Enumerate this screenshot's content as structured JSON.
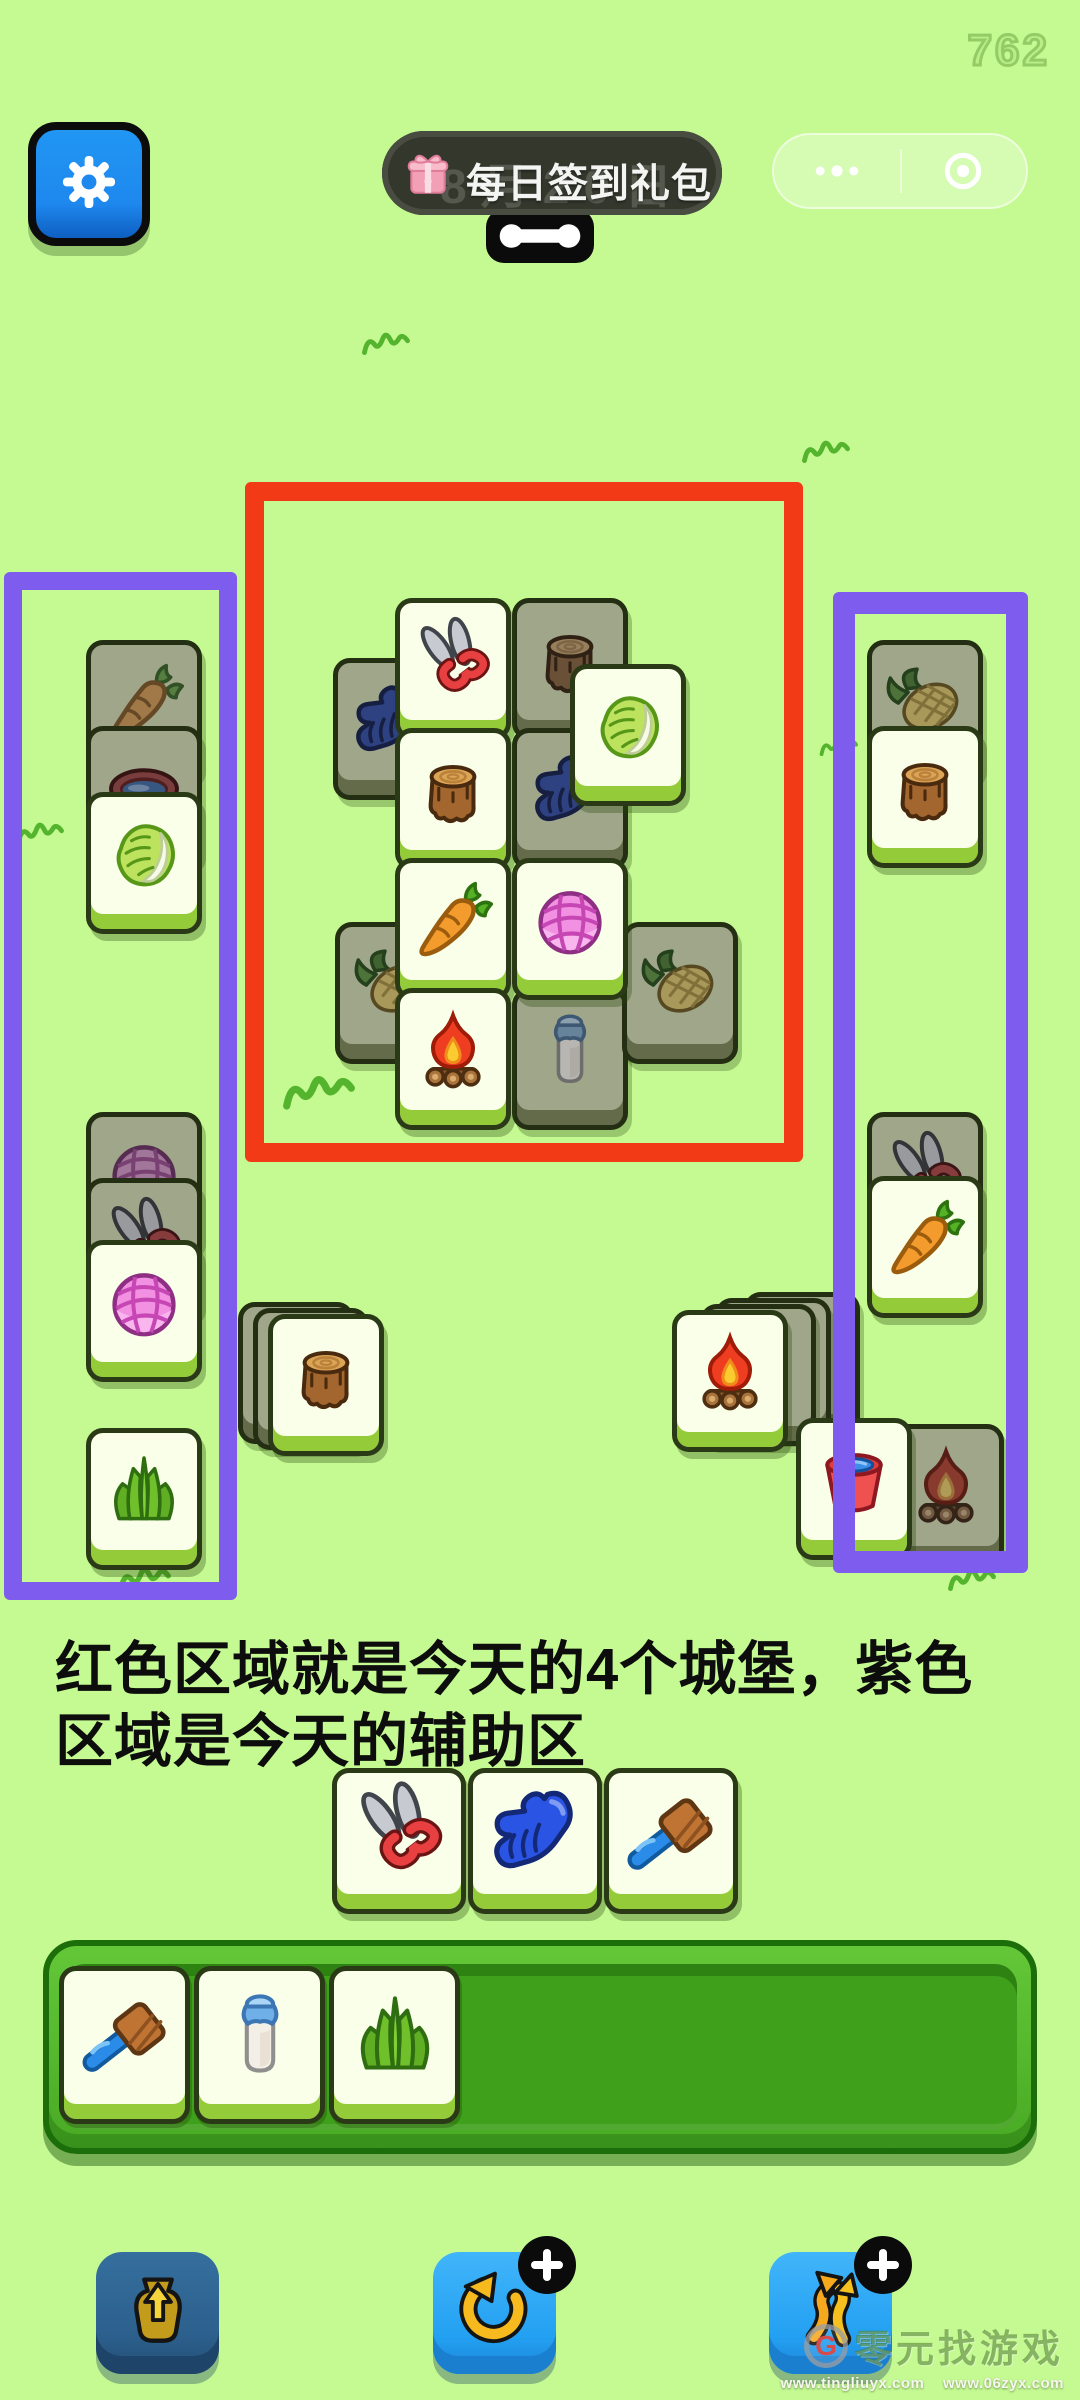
{
  "hud": {
    "counter": "762"
  },
  "topbar": {
    "signin": {
      "label": "每日签到礼包",
      "ghost_date": "8月20日"
    }
  },
  "caption": {
    "line1": "红色区域就是今天的4个城堡，紫色",
    "line2": "区域是今天的辅助区"
  },
  "watermark": {
    "logo_letter": "G",
    "brand": "零元找游戏",
    "url1": "www.tingliuyx.com",
    "url2": "www.06zyx.com"
  },
  "colors": {
    "background": "#c5fa93",
    "red_region": "#f23a17",
    "purple_region": "#7e5cee",
    "tile_face": "#f9ffe8",
    "tile_face_covered": "#a0a68a",
    "button_blue": "#29a4f5",
    "settings_blue": "#1e88ee",
    "signin_pill": "#33372c"
  },
  "board": {
    "tile_w": 116,
    "tile_h": 142,
    "tiles": [
      {
        "icon": "stump",
        "state": "covered",
        "x": 512,
        "y": 598
      },
      {
        "icon": "glove",
        "state": "covered",
        "x": 333,
        "y": 658
      },
      {
        "icon": "shears",
        "state": "open",
        "x": 395,
        "y": 598
      },
      {
        "icon": "glove",
        "state": "covered",
        "x": 512,
        "y": 728
      },
      {
        "icon": "cabbage",
        "state": "open",
        "x": 570,
        "y": 664
      },
      {
        "icon": "stump",
        "state": "open",
        "x": 395,
        "y": 728
      },
      {
        "icon": "corn",
        "state": "covered",
        "x": 335,
        "y": 922
      },
      {
        "icon": "milk",
        "state": "covered",
        "x": 512,
        "y": 988
      },
      {
        "icon": "corn",
        "state": "covered",
        "x": 622,
        "y": 922
      },
      {
        "icon": "carrot",
        "state": "open",
        "x": 395,
        "y": 858
      },
      {
        "icon": "yarn",
        "state": "open",
        "x": 512,
        "y": 858
      },
      {
        "icon": "fire",
        "state": "open",
        "x": 395,
        "y": 988
      },
      {
        "icon": "carrot",
        "state": "covered",
        "x": 86,
        "y": 640
      },
      {
        "icon": "basin",
        "state": "covered",
        "x": 86,
        "y": 726
      },
      {
        "icon": "cabbage",
        "state": "open",
        "x": 86,
        "y": 792
      },
      {
        "icon": "yarn",
        "state": "covered",
        "x": 86,
        "y": 1112
      },
      {
        "icon": "shears",
        "state": "covered",
        "x": 86,
        "y": 1178
      },
      {
        "icon": "yarn",
        "state": "open",
        "x": 86,
        "y": 1240
      },
      {
        "icon": "grass",
        "state": "open",
        "x": 86,
        "y": 1428
      },
      {
        "icon": "stump",
        "state": "covered",
        "x": 238,
        "y": 1302
      },
      {
        "icon": "stump",
        "state": "covered",
        "x": 253,
        "y": 1308
      },
      {
        "icon": "stump",
        "state": "open",
        "x": 268,
        "y": 1314
      },
      {
        "icon": "fire",
        "state": "covered",
        "x": 744,
        "y": 1292
      },
      {
        "icon": "fire",
        "state": "covered",
        "x": 715,
        "y": 1298
      },
      {
        "icon": "fire",
        "state": "covered",
        "x": 700,
        "y": 1304
      },
      {
        "icon": "fire",
        "state": "open",
        "x": 672,
        "y": 1310
      },
      {
        "icon": "corn",
        "state": "covered",
        "x": 867,
        "y": 640
      },
      {
        "icon": "stump",
        "state": "open",
        "x": 867,
        "y": 726
      },
      {
        "icon": "shears",
        "state": "covered",
        "x": 867,
        "y": 1112
      },
      {
        "icon": "carrot",
        "state": "open",
        "x": 867,
        "y": 1176
      },
      {
        "icon": "fire",
        "state": "covered",
        "x": 888,
        "y": 1424
      },
      {
        "icon": "bucket",
        "state": "open",
        "x": 796,
        "y": 1418
      }
    ],
    "regions": [
      {
        "name": "red-castle-region",
        "x": 245,
        "y": 482,
        "w": 558,
        "h": 680,
        "border": 19,
        "color": "#f23a17"
      },
      {
        "name": "purple-helper-left",
        "x": 4,
        "y": 572,
        "w": 233,
        "h": 1028,
        "border": 18,
        "color": "#7e5cee"
      },
      {
        "name": "purple-helper-right",
        "x": 833,
        "y": 592,
        "w": 195,
        "h": 981,
        "border": 22,
        "color": "#7e5cee"
      }
    ],
    "doodles": [
      {
        "x": 360,
        "y": 330,
        "s": 1
      },
      {
        "x": 800,
        "y": 438,
        "s": 1
      },
      {
        "x": 14,
        "y": 820,
        "s": 1
      },
      {
        "x": 818,
        "y": 736,
        "s": 0.8
      },
      {
        "x": 280,
        "y": 1072,
        "s": 1.5
      },
      {
        "x": 116,
        "y": 1564,
        "s": 1.1
      },
      {
        "x": 946,
        "y": 1566,
        "s": 1
      }
    ]
  },
  "tray": {
    "w": 134,
    "h": 146,
    "y": 1768,
    "tiles": [
      {
        "icon": "shears",
        "x": 332
      },
      {
        "icon": "glove",
        "x": 468
      },
      {
        "icon": "brush",
        "x": 604
      }
    ]
  },
  "slotbar": {
    "w": 131,
    "h": 158,
    "y": 1966,
    "tiles": [
      {
        "icon": "brush",
        "x": 59
      },
      {
        "icon": "milk",
        "x": 194
      },
      {
        "icon": "grass",
        "x": 329
      }
    ]
  },
  "buttons": [
    {
      "name": "bag-button",
      "icon": "bag",
      "variant": "dark",
      "x": 96,
      "y": 2252,
      "w": 123,
      "h": 122,
      "badge": false
    },
    {
      "name": "undo-button",
      "icon": "undo",
      "variant": "bright",
      "x": 433,
      "y": 2252,
      "w": 123,
      "h": 122,
      "badge": true
    },
    {
      "name": "shuffle-button",
      "icon": "shuffle",
      "variant": "bright",
      "x": 769,
      "y": 2252,
      "w": 123,
      "h": 122,
      "badge": true
    }
  ]
}
